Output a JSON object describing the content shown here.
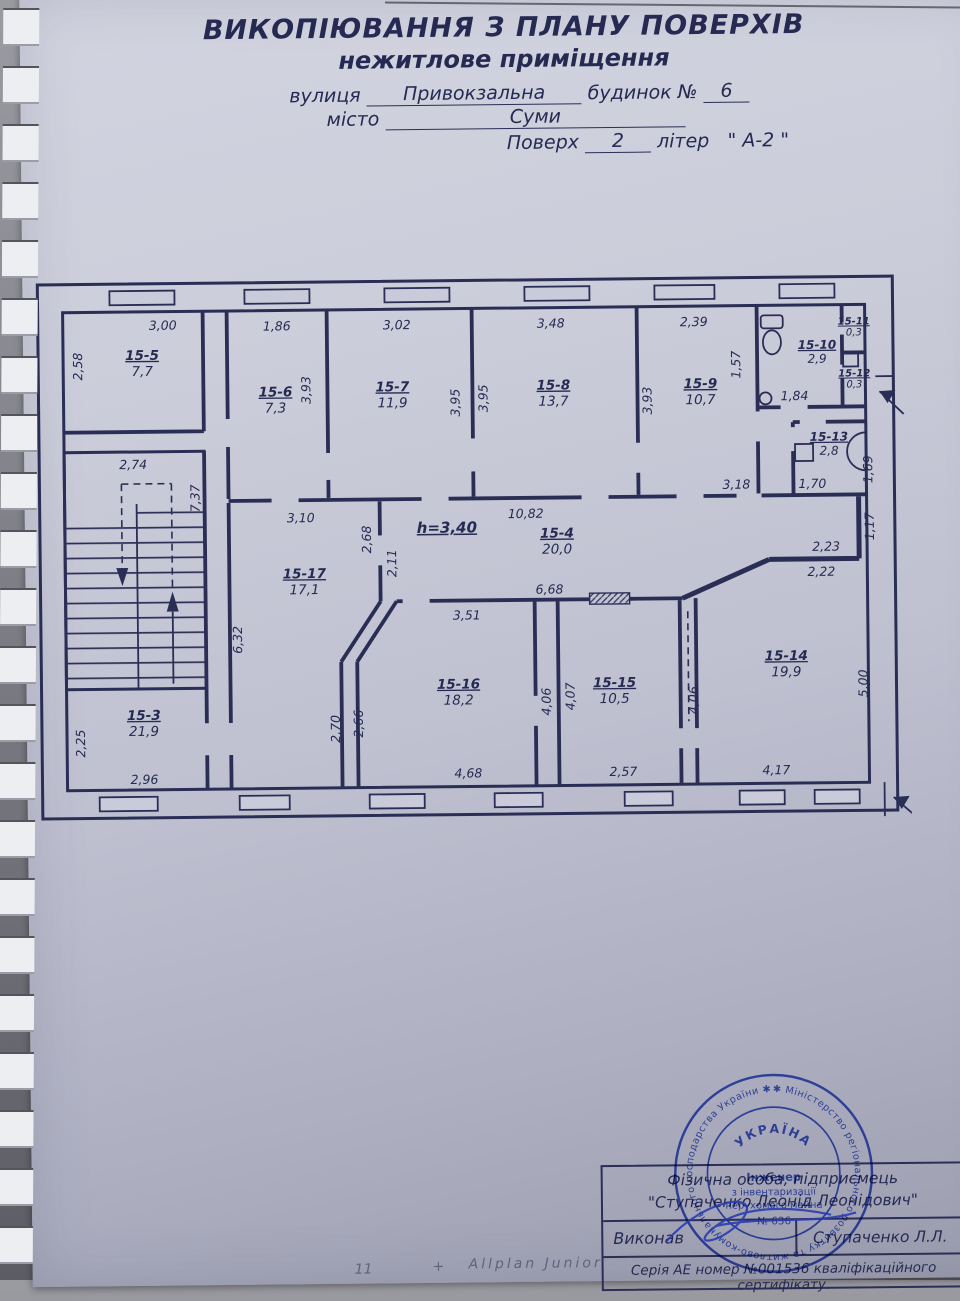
{
  "title": {
    "line1": "ВИКОПІЮВАННЯ З ПЛАНУ ПОВЕРХІВ",
    "line2": "нежитлове приміщення",
    "street_label": "вулиця",
    "street_value": "Привокзальна",
    "building_label": "будинок №",
    "building_value": "6",
    "city_label": "місто",
    "city_value": "Суми",
    "floor_label": "Поверх",
    "floor_value": "2",
    "letter_label": "літер",
    "letter_value": "\" А-2 \""
  },
  "plan": {
    "height_note": "h=3,40",
    "rooms": [
      {
        "id": "15-5",
        "area": "7,7"
      },
      {
        "id": "15-6",
        "area": "7,3"
      },
      {
        "id": "15-7",
        "area": "11,9"
      },
      {
        "id": "15-8",
        "area": "13,7"
      },
      {
        "id": "15-9",
        "area": "10,7"
      },
      {
        "id": "15-10",
        "area": "2,9"
      },
      {
        "id": "15-11",
        "area": "0,3"
      },
      {
        "id": "15-12",
        "area": "0,3"
      },
      {
        "id": "15-13",
        "area": "2,8"
      },
      {
        "id": "15-4",
        "area": "20,0"
      },
      {
        "id": "15-17",
        "area": "17,1"
      },
      {
        "id": "15-3",
        "area": "21,9"
      },
      {
        "id": "15-16",
        "area": "18,2"
      },
      {
        "id": "15-15",
        "area": "10,5"
      },
      {
        "id": "15-14",
        "area": "19,9"
      }
    ],
    "dims": {
      "d0": "3,00",
      "d1": "2,58",
      "d2": "1,86",
      "d3": "3,93",
      "d4": "3,02",
      "d5": "3,95",
      "d6": "3,95",
      "d7": "3,48",
      "d8": "3,93",
      "d9": "2,39",
      "d10": "1,57",
      "d11": "1,84",
      "d12": "3,18",
      "d13": "1,70",
      "d14": "1,69",
      "d15": "3,10",
      "d16": "2,68",
      "d17": "2,11",
      "d18": "h=3,40",
      "d19": "10,82",
      "d20": "6,68",
      "d21": "2,23",
      "d22": "2,22",
      "d23": "1,17",
      "d24": "6,32",
      "d25": "2,74",
      "d26": "7,37",
      "d27": "2,25",
      "d28": "2,96",
      "d29": "3,51",
      "d30": "2,70",
      "d31": "2,66",
      "d32": "4,68",
      "d33": "4,06",
      "d34": "4,07",
      "d35": "2,57",
      "d36": "4,06",
      "d37": "5,00",
      "d38": "4,17"
    }
  },
  "stamp_table": {
    "row1_line1": "Фізична особа, підприємець",
    "row1_line2": "\"Ступаченко Леонід Леонідович\"",
    "executed_label": "Виконав",
    "executed_by": "Ступаченко Л.Л.",
    "certificate": "Серія АЕ номер №001536 кваліфікаційного сертифікату."
  },
  "seal": {
    "ring": "✱ Міністерство регіонального розвитку та житлово-комунального господарства України ✱ атестаційна архітектурно-будівельна комісія",
    "country": "УКРАЇНА",
    "role1": "Інженер",
    "role2": "з інвентаризації",
    "role3": "нерухомого майна",
    "number": "№ 636"
  },
  "footer": {
    "note_left": "11",
    "note_plus": "+",
    "software": "Allplan Junior"
  },
  "colors": {
    "ink": "#262a52",
    "paper": "#c9cbda",
    "seal_blue": "#2c47c5"
  }
}
